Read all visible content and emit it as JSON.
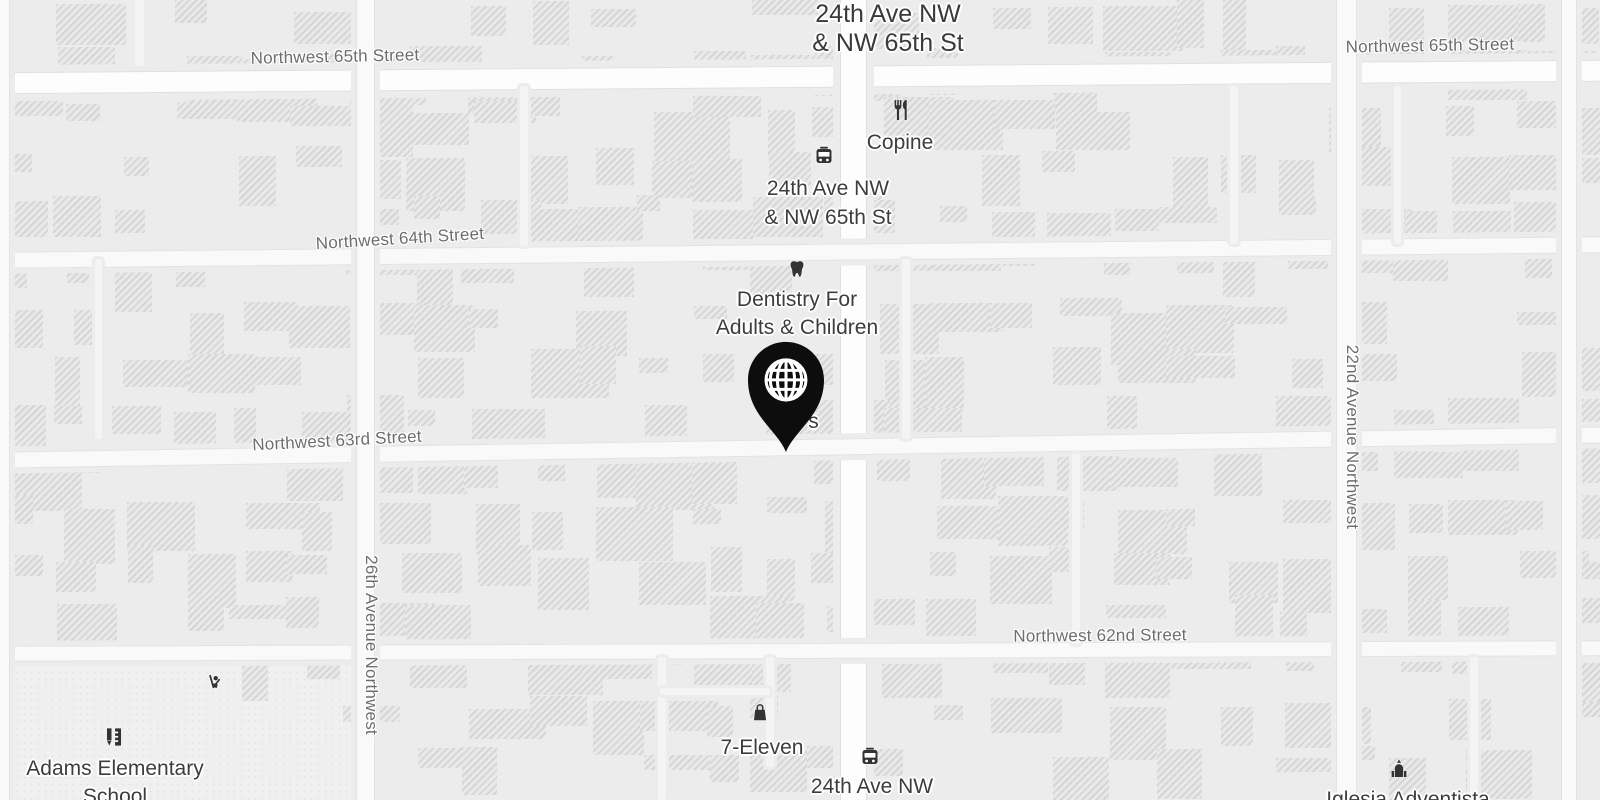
{
  "map": {
    "name": "grayscale-street-map",
    "colors": {
      "background": "#ececec",
      "road_main": "#fdfdfd",
      "road_minor": "#f9f9f9",
      "building": "#e9e9e9",
      "street_label": "#6d6d6d",
      "poi_label": "#3d3d3d",
      "marker": "#0d0d0d",
      "icon": "#333333"
    }
  },
  "street_labels": [
    {
      "text": "Northwest 65th Street",
      "x": 335,
      "y": 57,
      "rot": -1.2,
      "vertical": false
    },
    {
      "text": "Northwest 65th Street",
      "x": 1430,
      "y": 46,
      "rot": -1,
      "vertical": false
    },
    {
      "text": "Northwest 64th Street",
      "x": 400,
      "y": 239,
      "rot": -3.5,
      "vertical": false
    },
    {
      "text": "Northwest 63rd Street",
      "x": 337,
      "y": 441,
      "rot": -3,
      "vertical": false
    },
    {
      "text": "Northwest 62nd Street",
      "x": 1100,
      "y": 636,
      "rot": -0.5,
      "vertical": false
    },
    {
      "text": "26th Avenue Northwest",
      "x": 371,
      "y": 645,
      "rot": 0,
      "vertical": true
    },
    {
      "text": "22nd Avenue Northwest",
      "x": 1352,
      "y": 437,
      "rot": 0,
      "vertical": true
    }
  ],
  "pois": [
    {
      "id": "intersection-title",
      "kind": "title",
      "lines": [
        "24th Ave NW",
        "& NW 65th St"
      ],
      "x": 888,
      "y": 0,
      "size": 25,
      "lh": 29
    },
    {
      "id": "bus-stop-65th",
      "icon": "bus",
      "icon_x": 824,
      "icon_y": 156,
      "icon_size": 24,
      "lines": [
        "24th Ave NW",
        "& NW 65th St"
      ],
      "x": 828,
      "y": 174,
      "size": 21,
      "lh": 29
    },
    {
      "id": "copine",
      "icon": "restaurant",
      "icon_x": 900,
      "icon_y": 110,
      "icon_size": 24,
      "lines": [
        "Copine"
      ],
      "x": 900,
      "y": 129,
      "size": 21,
      "lh": 28
    },
    {
      "id": "dentistry",
      "icon": "tooth",
      "icon_x": 797,
      "icon_y": 269,
      "icon_size": 22,
      "lines": [
        "Dentistry For",
        "Adults & Children"
      ],
      "x": 797,
      "y": 286,
      "size": 21,
      "lh": 28
    },
    {
      "id": "obscured-poi",
      "lines": [
        "r's"
      ],
      "x": 808,
      "y": 408,
      "size": 21,
      "lh": 28
    },
    {
      "id": "seven-eleven",
      "icon": "bag",
      "icon_x": 760,
      "icon_y": 712,
      "icon_size": 22,
      "lines": [
        "7-Eleven"
      ],
      "x": 762,
      "y": 734,
      "size": 21,
      "lh": 28
    },
    {
      "id": "bus-stop-62nd",
      "icon": "bus",
      "icon_x": 870,
      "icon_y": 757,
      "icon_size": 24,
      "lines": [
        "24th Ave NW"
      ],
      "x": 872,
      "y": 773,
      "size": 21,
      "lh": 28
    },
    {
      "id": "adams-school",
      "icon": "school",
      "icon_x": 114,
      "icon_y": 737,
      "icon_size": 26,
      "lines": [
        "Adams Elementary",
        "School"
      ],
      "x": 115,
      "y": 755,
      "size": 21,
      "lh": 28
    },
    {
      "id": "iglesia-adventista",
      "icon": "church",
      "icon_x": 1399,
      "icon_y": 769,
      "icon_size": 24,
      "lines": [
        "Iglesia Adventista"
      ],
      "x": 1408,
      "y": 786,
      "size": 21,
      "lh": 28
    },
    {
      "id": "playground",
      "icon": "playground",
      "icon_x": 215,
      "icon_y": 682,
      "icon_size": 22,
      "lines": null
    }
  ],
  "marker": {
    "x": 786,
    "y": 454,
    "w": 104,
    "h": 114,
    "icon": "globe",
    "color": "#0d0d0d"
  }
}
